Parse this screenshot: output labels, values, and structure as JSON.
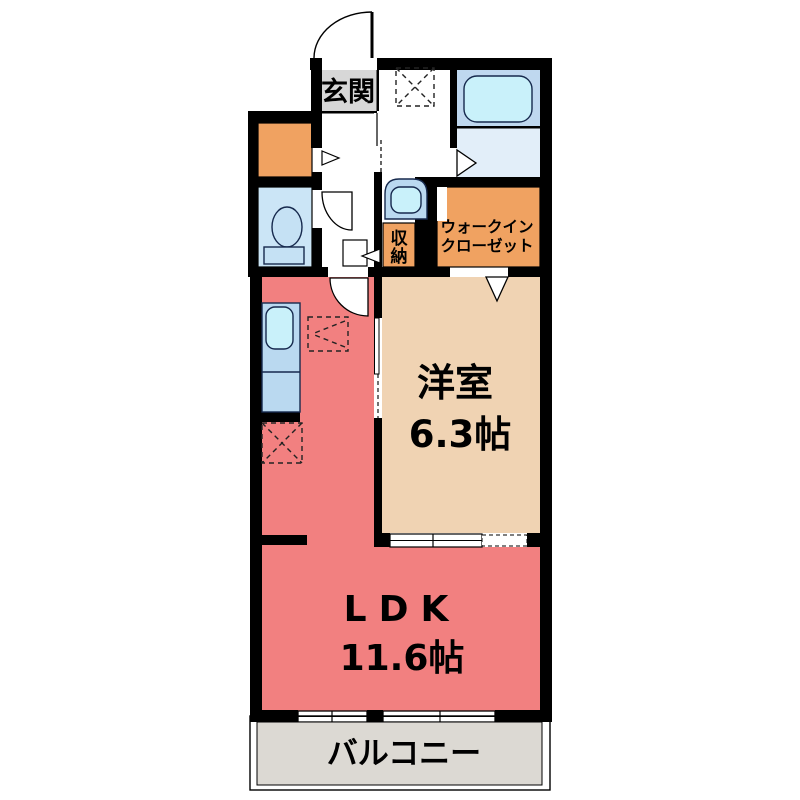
{
  "title": "間取り図 (floor plan)",
  "colors": {
    "wall": "#000000",
    "background": "#ffffff",
    "ldk": "#F28080",
    "western_room": "#F0D3B3",
    "orange_storage": "#F0A261",
    "genkan_gray": "#D7D7D7",
    "balcony_gray": "#DCD9D3",
    "toilet_room": "#CBE5F6",
    "bath_upper": "#BFD8EF",
    "bath_lower": "#E2EEF9",
    "fixture_blue": "#BAD9F0",
    "toilet_fixture": "#C5E1F4",
    "water_cyan": "#C9F1FA"
  },
  "rooms": {
    "genkan": {
      "label": "玄関"
    },
    "walk_in_closet": {
      "line1": "ウォークイン",
      "line2": "クローゼット"
    },
    "storage": {
      "label": "収納",
      "char1": "収",
      "char2": "納"
    },
    "western_room": {
      "label": "洋室",
      "size": "6.3帖"
    },
    "ldk": {
      "label": "LDK",
      "size": "11.6帖"
    },
    "balcony": {
      "label": "バルコニー"
    }
  }
}
